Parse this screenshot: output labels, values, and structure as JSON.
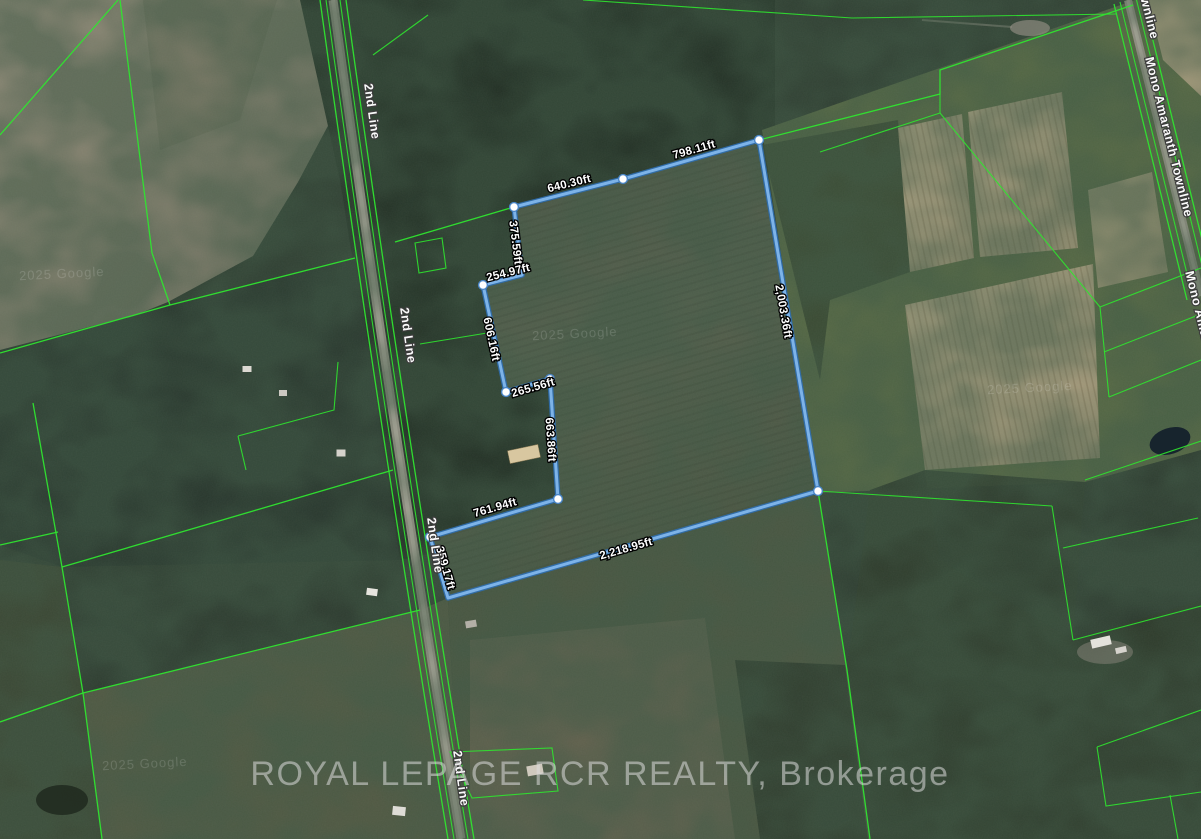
{
  "watermarks": {
    "brokerage": "ROYAL LEPAGE RCR REALTY, Brokerage",
    "imagery_credit": "2025 Google"
  },
  "roads": {
    "second_line": {
      "name": "2nd Line"
    },
    "mono_amaranth_townline": {
      "name": "Mono Amaranth Townline"
    }
  },
  "parcel": {
    "boundary_color": "#5b9ad2",
    "vertex_color": "#ffffff",
    "measurements": [
      {
        "side": "north-east",
        "text": "798.11ft"
      },
      {
        "side": "north-west",
        "text": "640.30ft"
      },
      {
        "side": "west-upper",
        "text": "375.59ft"
      },
      {
        "side": "west-jog",
        "text": "254.97ft"
      },
      {
        "side": "west-mid",
        "text": "606.16ft"
      },
      {
        "side": "west-jog-2",
        "text": "265.56ft"
      },
      {
        "side": "west-lower",
        "text": "663.86ft"
      },
      {
        "side": "south-west",
        "text": "761.94ft"
      },
      {
        "side": "road-frontage",
        "text": "359.17ft"
      },
      {
        "side": "south",
        "text": "2,218.95ft"
      },
      {
        "side": "east",
        "text": "2,003.36ft"
      }
    ]
  },
  "cadastral": {
    "line_color": "#2fe52f"
  }
}
